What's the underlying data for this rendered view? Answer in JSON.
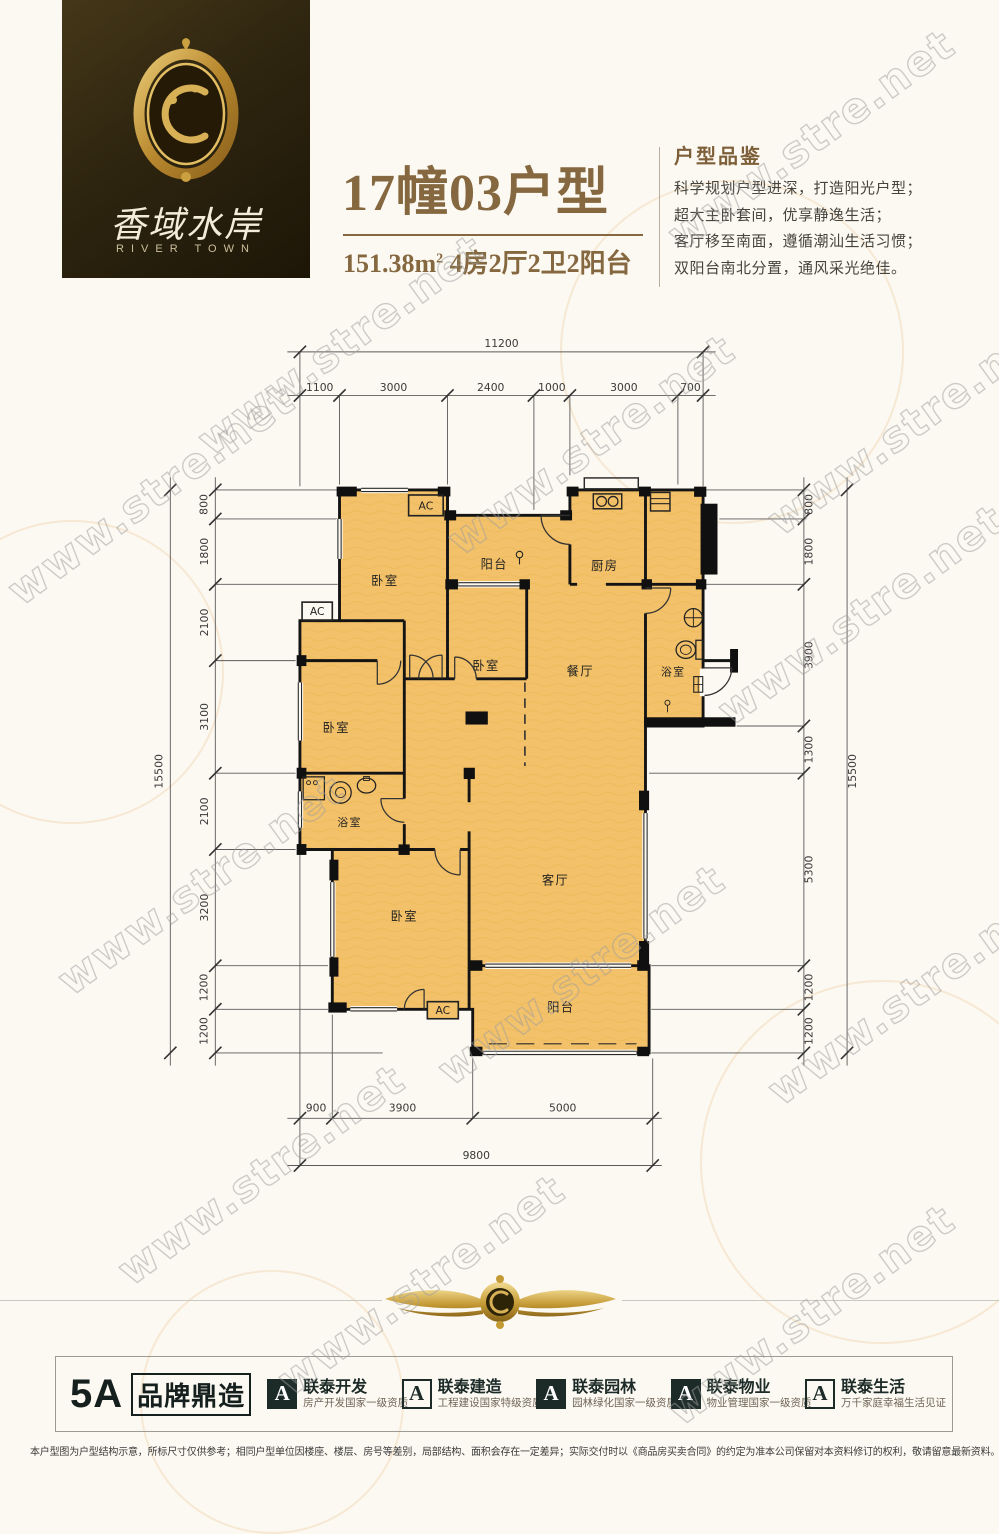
{
  "watermark": {
    "text": "www.stre.net"
  },
  "colors": {
    "floor": "#f3c169",
    "wall": "#141414",
    "accent_brown": "#85683f",
    "brand_dark": "#1d2b28",
    "logo_gold": "#c9a23c"
  },
  "header": {
    "logo": {
      "name_cn": "香域水岸",
      "name_en": "RIVER TOWN"
    },
    "title": "17幢03户型",
    "area_value": "151.38m",
    "area_sup": "2",
    "layout_summary": "4房2厅2卫2阳台",
    "review": {
      "heading": "户型品鉴",
      "lines": [
        "科学规划户型进深，打造阳光户型；",
        "超大主卧套间，优享静逸生活；",
        "客厅移至南面，遵循潮汕生活习惯；",
        "双阳台南北分置，通风采光绝佳。"
      ]
    }
  },
  "floorplan": {
    "ac_label": "AC",
    "rooms": [
      {
        "label": "卧室"
      },
      {
        "label": "阳台"
      },
      {
        "label": "厨房"
      },
      {
        "label": "卧室"
      },
      {
        "label": "餐厅"
      },
      {
        "label": "浴室"
      },
      {
        "label": "卧室"
      },
      {
        "label": "浴室"
      },
      {
        "label": "卧室"
      },
      {
        "label": "客厅"
      },
      {
        "label": "阳台"
      }
    ],
    "dimensions": {
      "top": {
        "total": "11200",
        "segments": [
          "1100",
          "3000",
          "2400",
          "1000",
          "3000",
          "700"
        ]
      },
      "left": {
        "total": "15500",
        "segments": [
          "800",
          "1800",
          "2100",
          "3100",
          "2100",
          "3200",
          "1200",
          "1200"
        ]
      },
      "right": {
        "total": "15500",
        "segments": [
          "800",
          "1800",
          "3900",
          "1300",
          "5300",
          "1200",
          "1200"
        ]
      },
      "bottom": {
        "total": "9800",
        "segments": [
          "900",
          "3900",
          "5000"
        ]
      }
    }
  },
  "footer": {
    "brand_bar": {
      "badge": "5A",
      "badge_text": "品牌鼎造",
      "items": [
        {
          "title": "联泰开发",
          "subtitle": "房产开发国家一级资质"
        },
        {
          "title": "联泰建造",
          "subtitle": "工程建设国家特级资质"
        },
        {
          "title": "联泰园林",
          "subtitle": "园林绿化国家一级资质"
        },
        {
          "title": "联泰物业",
          "subtitle": "物业管理国家一级资质"
        },
        {
          "title": "联泰生活",
          "subtitle": "万千家庭幸福生活见证"
        }
      ]
    },
    "disclaimer": "本户型图为户型结构示意，所标尺寸仅供参考；相同户型单位因楼座、楼层、房号等差别，局部结构、面积会存在一定差异；实际交付时以《商品房买卖合同》的约定为准本公司保留对本资料修订的权利，敬请留意最新资料。"
  }
}
